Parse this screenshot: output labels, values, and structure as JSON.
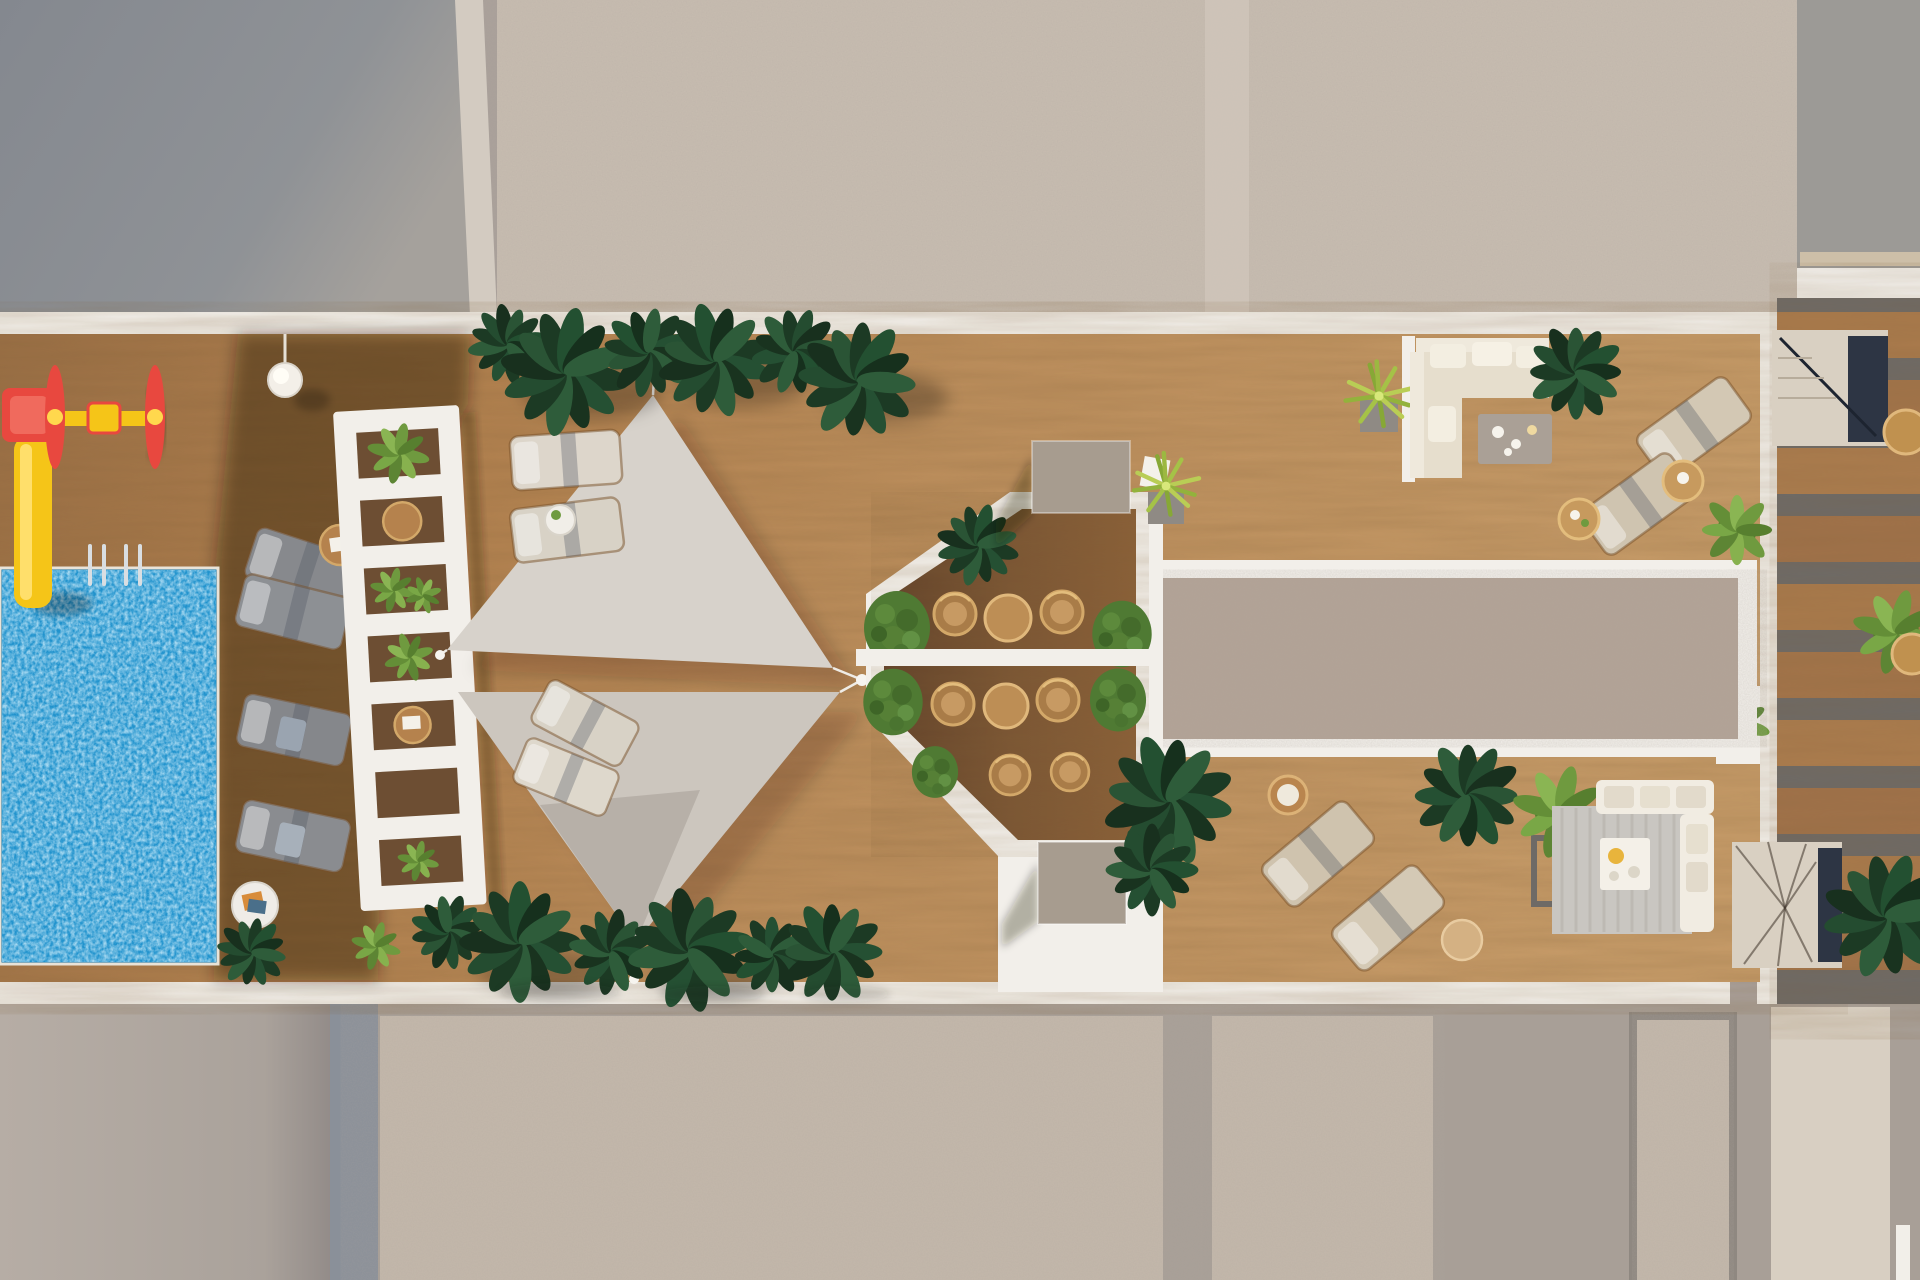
{
  "scene": {
    "kind": "architectural-3d-render",
    "view": "top-down-aerial",
    "subject": "rooftop amenity terrace with pool, shade sails, pergola and lounge areas"
  },
  "palette": {
    "deck_wood": "#b4854f",
    "deck_wood_dark": "#5e4530",
    "octagon_floor": "#7b5634",
    "pool_blue": "#2193cd",
    "pool_sparkle": "#bfe9ff",
    "concrete_speckle": "#c8bdb1",
    "concrete_speckle_warm": "#b2a295",
    "concrete_plain": "#a89f97",
    "gray_block": "#8c9095",
    "white_structure": "#f2efea",
    "sail_fabric_upper": "#d7d2cb",
    "sail_fabric_lower": "#ccc6be",
    "foliage_dark": "#1c3a24",
    "foliage_light": "#6f9a3f",
    "hedge_green": "#4f7a33",
    "rattan_wood": "#bd8e55",
    "taupe_block": "#a79c8f",
    "lounger_gray": "#87898d",
    "lounger_cream": "#d3c8b4",
    "sofa_cream": "#e6decd",
    "stair_beige": "#d9d0c2",
    "navy_shadow": "#2d3544",
    "walkway_beige": "#d8cfc2",
    "slat_gap_gray": "#6e6a66",
    "playground_red": "#e8483f",
    "playground_yellow": "#f5c518",
    "rug_gray": "#c9c6c1"
  },
  "inventory": {
    "swimming_pool": 1,
    "water_slide": 1,
    "playground_spinner": 1,
    "shade_sails": 2,
    "pergola_planter_wall": 1,
    "octagon_dining_pod": 1,
    "sun_loungers_gray": 4,
    "sun_loungers_cream": 8,
    "outdoor_sofa_sets": 2,
    "round_side_tables": 8,
    "staircases": 2,
    "plant_clusters": 14
  }
}
